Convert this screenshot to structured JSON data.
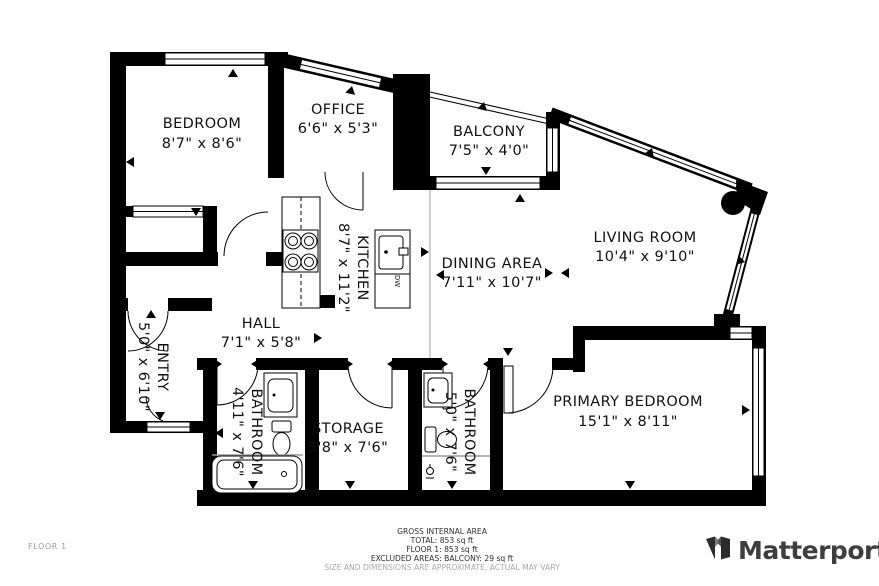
{
  "floorplan": {
    "rooms": {
      "bedroom": {
        "name": "BEDROOM",
        "dims": "8'7\" x 8'6\""
      },
      "office": {
        "name": "OFFICE",
        "dims": "6'6\" x 5'3\""
      },
      "balcony": {
        "name": "BALCONY",
        "dims": "7'5\" x 4'0\""
      },
      "living_room": {
        "name": "LIVING ROOM",
        "dims": "10'4\" x 9'10\""
      },
      "kitchen": {
        "name": "KITCHEN",
        "dims": "8'7\" x 11'2\""
      },
      "dining_area": {
        "name": "DINING AREA",
        "dims": "7'11\" x 10'7\""
      },
      "hall": {
        "name": "HALL",
        "dims": "7'1\" x 5'8\""
      },
      "entry": {
        "name": "ENTRY",
        "dims": "5'0\" x 6'10\""
      },
      "bathroom_1": {
        "name": "BATHROOM",
        "dims": "4'11\" x 7'6\""
      },
      "storage": {
        "name": "STORAGE",
        "dims": "5'8\" x 7'6\""
      },
      "bathroom_2": {
        "name": "BATHROOM",
        "dims": "5'0\" x 7'6\""
      },
      "primary_bedroom": {
        "name": "PRIMARY BEDROOM",
        "dims": "15'1\" x 8'11\""
      }
    },
    "appliances": {
      "dishwasher": "DW"
    }
  },
  "footer": {
    "floor_label": "FLOOR 1",
    "gross_internal_area_title": "GROSS INTERNAL AREA",
    "total": "TOTAL: 853 sq ft",
    "floor_1": "FLOOR 1: 853 sq ft",
    "excluded": "EXCLUDED AREAS: BALCONY: 29 sq ft",
    "disclaimer": "SIZE AND DIMENSIONS ARE APPROXIMATE, ACTUAL MAY VARY",
    "brand": "Matterport"
  },
  "colors": {
    "wall": "#000000",
    "label": "#111111",
    "muted": "#9b9b9b",
    "brand_text": "#3e3e3e"
  }
}
